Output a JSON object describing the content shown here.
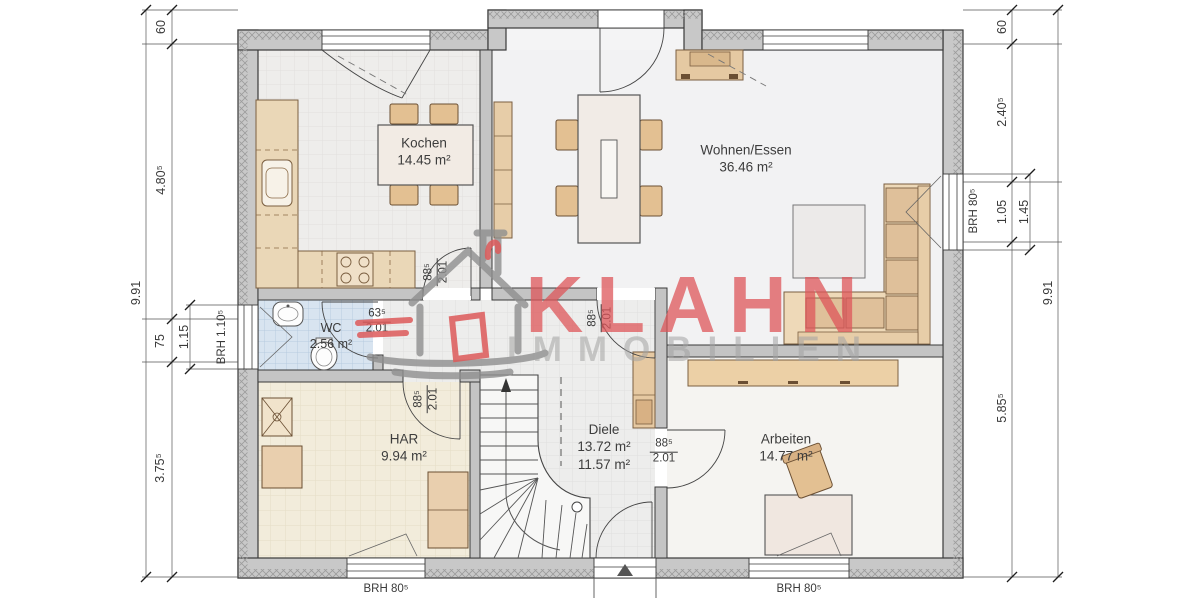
{
  "watermark": {
    "brand": "KLAHN",
    "subtitle": "IMMOBILIEN"
  },
  "rooms": {
    "kochen": {
      "name": "Kochen",
      "area": "14.45 m²"
    },
    "wohnen": {
      "name": "Wohnen/Essen",
      "area": "36.46 m²"
    },
    "wc": {
      "name": "WC",
      "area": "2.56 m²"
    },
    "har": {
      "name": "HAR",
      "area": "9.94 m²"
    },
    "diele": {
      "name": "Diele",
      "area1": "13.72 m²",
      "area2": "11.57 m²"
    },
    "arbeiten": {
      "name": "Arbeiten",
      "area": "14.77 m²"
    }
  },
  "dims": {
    "left_total": "9.91",
    "left_top": "60",
    "left_a": "4.80⁵",
    "left_b": "75",
    "left_window": "1.15",
    "left_c": "3.75⁵",
    "right_total": "9.91",
    "right_top": "60",
    "right_a": "2.40⁵",
    "right_b": "1.05",
    "right_window": "1.45",
    "right_c": "5.85⁵"
  },
  "brh": {
    "wc": "BRH 1.10⁵",
    "wohnen": "BRH 80⁵",
    "har": "BRH 80⁵",
    "arbeiten": "BRH 80⁵"
  },
  "doors": {
    "kitchen": {
      "w": "88⁵",
      "h": "2.01"
    },
    "wohnen": {
      "w": "88⁵",
      "h": "2.01"
    },
    "har": {
      "w": "88⁵",
      "h": "2.01"
    },
    "wc": {
      "w": "63⁵",
      "h": "2.01"
    },
    "arbeiten": {
      "w": "88⁵",
      "h": "2.01"
    }
  },
  "colors": {
    "brand_red": "#de565a",
    "watermark_gray": "#a3a3a3",
    "wall_gray": "#c8c8c8",
    "wc_tile_blue": "#d8e4f0",
    "har_tile_cream": "#f2ecdb",
    "furniture_tan": "#e6c9a2"
  }
}
